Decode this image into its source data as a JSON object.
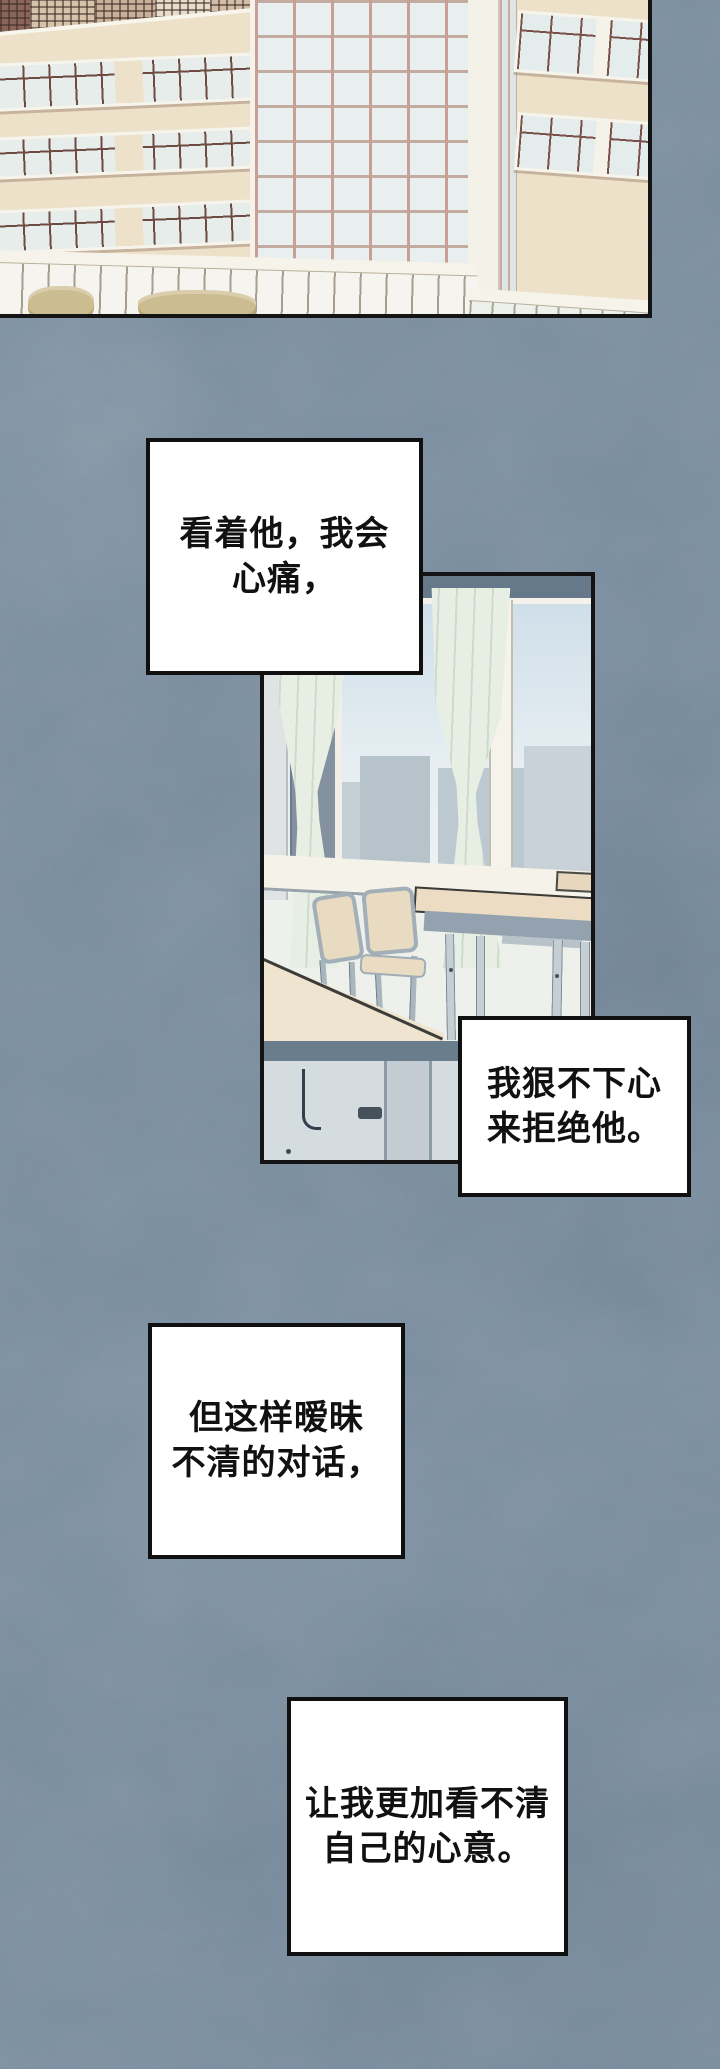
{
  "captions": [
    {
      "lines": [
        "看着他，我会",
        "心痛，"
      ]
    },
    {
      "lines": [
        "我狠不下心",
        "来拒绝他。"
      ]
    },
    {
      "lines": [
        "但这样暧昧",
        "不清的对话，"
      ]
    },
    {
      "lines": [
        "让我更加看不清",
        "自己的心意。"
      ]
    }
  ],
  "palette": {
    "page_background": "#75899b",
    "panel_border": "#141414",
    "caption_background": "#ffffff",
    "caption_text": "#111111",
    "building_facade": "#eee1c9",
    "window_mullion_brown": "#6d4b42",
    "window_glass": "#e6edeb",
    "glass_tower_mullion": "#c79f95",
    "curtain_green": "#e7efe5",
    "classroom_wall_blue": "#66798a",
    "desk_cream": "#ebdcc3",
    "metal_gray": "#93a2ae",
    "bush_olive": "#ccbd90"
  }
}
